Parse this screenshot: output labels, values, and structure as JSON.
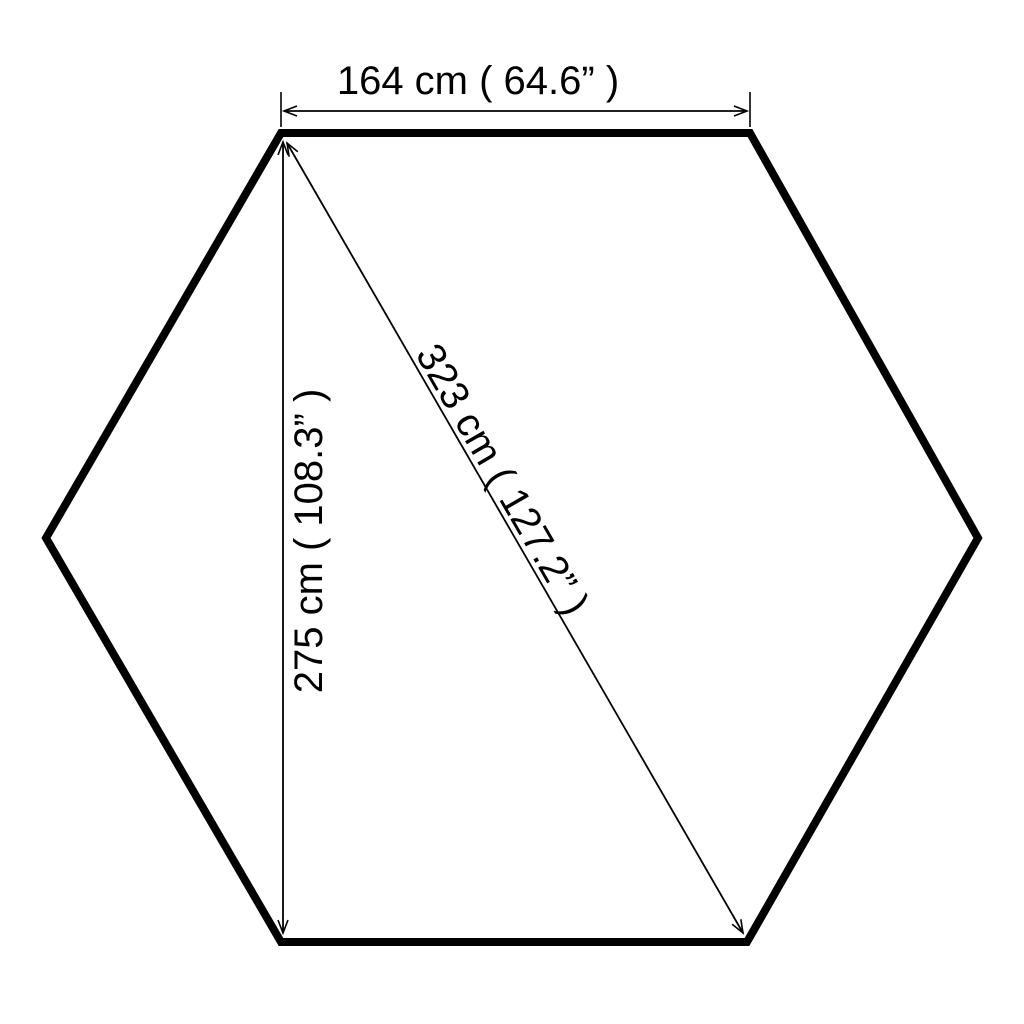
{
  "diagram": {
    "shape": "hexagon",
    "background_color": "#ffffff",
    "line_color": "#000000",
    "dimensions": {
      "top_width": {
        "label": "164 cm ( 64.6” )"
      },
      "side_height": {
        "label": "275 cm ( 108.3” )"
      },
      "diagonal": {
        "label": "323 cm ( 127.2” )"
      }
    }
  }
}
